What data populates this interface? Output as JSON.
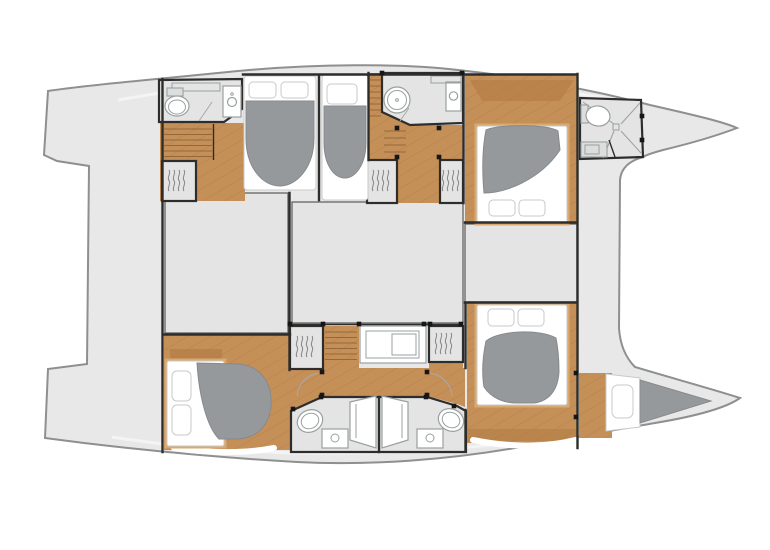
{
  "document": {
    "type": "yacht-floor-plan",
    "vessel": "catamaran",
    "view": "overhead interior deck plan",
    "orientation": "bow-right"
  },
  "canvas": {
    "width": 770,
    "height": 550
  },
  "colors": {
    "background": "#ffffff",
    "deck": "#e7e8e7",
    "floor": "#e3e4e3",
    "wall": "#2e2d2b",
    "outline": "#8e908f",
    "wood": "#c58f58",
    "wood_dark": "#b07a42",
    "wood_light": "#d9a96f",
    "plank_line": "#a4743f",
    "duvet": "#96999b",
    "duvet_edge": "#878a8c",
    "fixture_line": "#9aa0a0",
    "post": "#161616"
  },
  "rooms": [
    {
      "id": "aft-deck",
      "label": "aft cockpit deck spanning both hulls"
    },
    {
      "id": "hull-top-aft-heads",
      "label": "aft bathroom, top hull",
      "fixtures": [
        "toilet",
        "washbasin",
        "shelf"
      ]
    },
    {
      "id": "hull-top-staircase",
      "label": "companionway stairs, top hull"
    },
    {
      "id": "hull-top-aft-cabin",
      "label": "aft double cabin, top hull",
      "furniture": [
        "double bed",
        "wardrobe"
      ]
    },
    {
      "id": "hull-top-mid-cabin",
      "label": "middle double cabin, top hull",
      "furniture": [
        "double bed"
      ]
    },
    {
      "id": "hull-top-mid-heads",
      "label": "middle bathroom with round shower",
      "fixtures": [
        "round shower",
        "washbasin"
      ]
    },
    {
      "id": "hull-top-fwd-cabin",
      "label": "forward double cabin, top hull",
      "furniture": [
        "double bed",
        "wardrobe"
      ]
    },
    {
      "id": "hull-top-fwd-heads",
      "label": "forward bathroom in bow",
      "fixtures": [
        "toilet",
        "shower",
        "washbasin"
      ]
    },
    {
      "id": "salon-floor-left",
      "label": "main deck floor area, left"
    },
    {
      "id": "salon-floor-center",
      "label": "main deck floor area, center"
    },
    {
      "id": "salon-floor-right",
      "label": "main deck floor area, right"
    },
    {
      "id": "hull-bottom-aft-cabin",
      "label": "aft double cabin, bottom hull",
      "furniture": [
        "double bed",
        "wardrobe"
      ]
    },
    {
      "id": "hull-bottom-staircase",
      "label": "companionway stairs, bottom hull"
    },
    {
      "id": "hull-bottom-vanity",
      "label": "vanity desk unit"
    },
    {
      "id": "hull-bottom-twin-heads",
      "label": "twin mirrored bathrooms",
      "fixtures": [
        "2 toilets",
        "2 washbasins",
        "2 shower benches"
      ]
    },
    {
      "id": "hull-bottom-fwd-cabin",
      "label": "forward double cabin, bottom hull",
      "furniture": [
        "double bed"
      ]
    },
    {
      "id": "bow-berth",
      "label": "forepeak berth with cushion and pillow"
    }
  ],
  "counts": {
    "cabins": 5,
    "double_beds": 5,
    "forepeak_berths": 1,
    "bathrooms": 5,
    "wardrobes": 5,
    "staircases": 3
  }
}
